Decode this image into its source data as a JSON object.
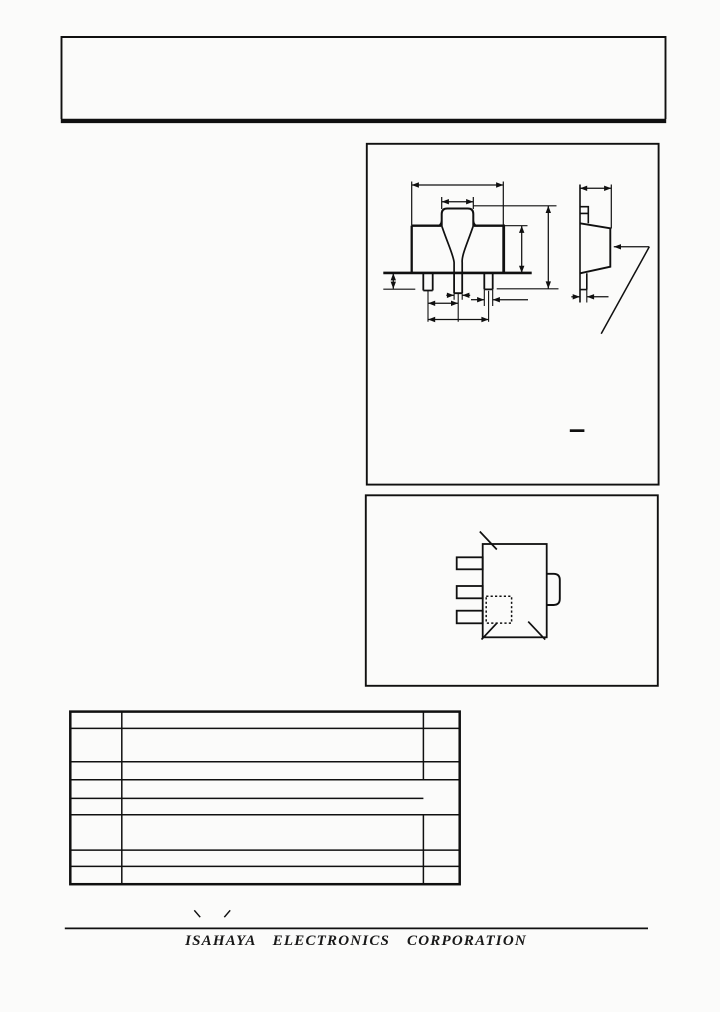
{
  "page": {
    "background": "#fbfbfa",
    "ink": "#101010"
  },
  "title_block": {
    "text": ""
  },
  "spec_table": {
    "rows": [
      [
        "",
        "",
        ""
      ],
      [
        "",
        "",
        ""
      ],
      [
        "",
        "",
        ""
      ],
      [
        "",
        "",
        ""
      ],
      [
        "",
        "",
        ""
      ],
      [
        "",
        "",
        ""
      ],
      [
        "",
        "",
        ""
      ],
      [
        "",
        "",
        ""
      ]
    ]
  },
  "footer": {
    "company": "ISAHAYA ELECTRONICS CORPORATION"
  }
}
